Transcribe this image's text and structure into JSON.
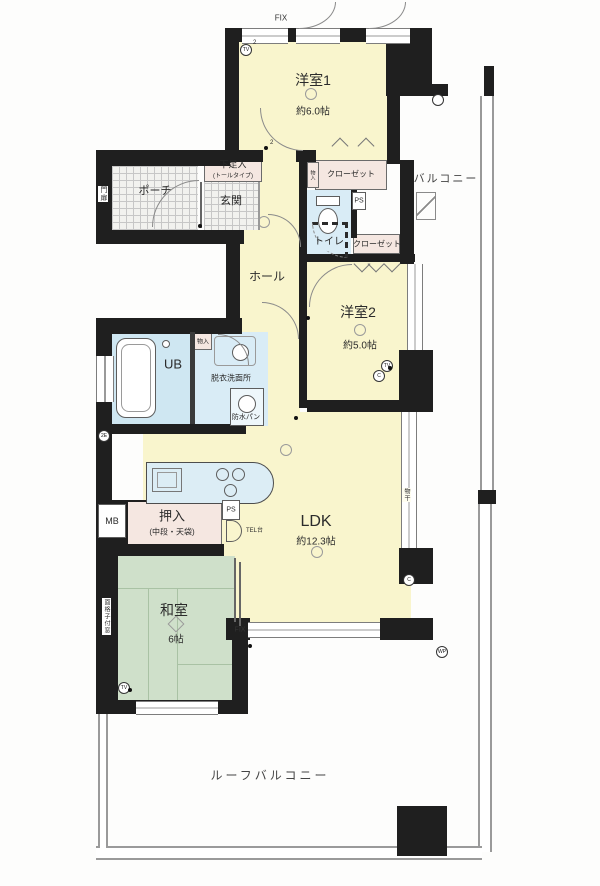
{
  "rooms": {
    "yoshitsu1": {
      "name": "洋室1",
      "size": "約6.0帖"
    },
    "yoshitsu2": {
      "name": "洋室2",
      "size": "約5.0帖"
    },
    "ldk": {
      "name": "LDK",
      "size": "約12.3帖"
    },
    "washitsu": {
      "name": "和室",
      "size": "6帖"
    },
    "hall": "ホール",
    "genkan": "玄関",
    "porch": "ポーチ",
    "toilet": "トイレ",
    "unit_bath": "UB",
    "washroom": "脱衣洗面所",
    "waterproof_pan": "防水パン",
    "balcony": "バルコニー",
    "roof_balcony": "ルーフバルコニー"
  },
  "storage": {
    "closet_upper": "クローゼット",
    "closet_lower": "クローゼット",
    "monoire_upper": "物入",
    "monoire_wash": "物入",
    "oshiire": "押入",
    "oshiire_sub": "(中段・天袋)",
    "shoe_box": "下足入",
    "shoe_box_sub": "(トールタイプ)"
  },
  "annotations": {
    "fix_top": "FIX",
    "fix_bottom": "FIX",
    "ps_upper": "PS",
    "ps_lower": "PS",
    "meter_box": "MB",
    "tel_stand": "TEL台",
    "gate": "門扉",
    "grated_window": "面格子付窓",
    "drying_fixture": "物干"
  },
  "markers": {
    "tv": "TV",
    "c": "C",
    "wp": "WP",
    "e2": "2E",
    "two": "2"
  },
  "colors": {
    "wall": "#1f1f1f",
    "western_room": "#f9f5cd",
    "tatami": "#cfe0ca",
    "wet_area": "#d9ecf6",
    "storage": "#f5e7e1",
    "railing": "#9a9a9a"
  }
}
